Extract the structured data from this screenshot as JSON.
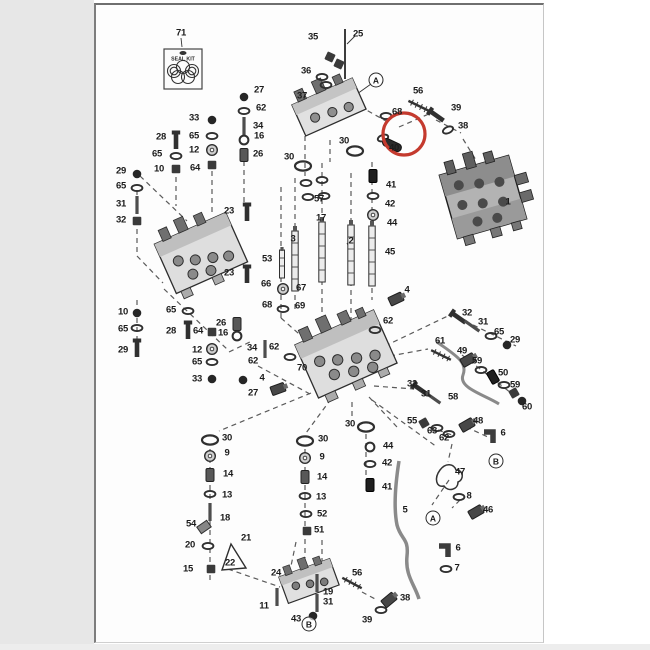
{
  "page": {
    "background": "#ffffff",
    "left_margin_color": "#e7e7e7",
    "paper_color": "#fdfdfd",
    "ink_color": "#2f2f2f"
  },
  "diagram": {
    "type": "exploded-parts-diagram",
    "subject": "hydraulic control valve assembly",
    "seal_kit": {
      "text": "SEAL KIT",
      "label": "71"
    },
    "highlight": {
      "circled_part": "40",
      "color": "#c43a2e",
      "cx": 404,
      "cy": 134,
      "r": 21,
      "stroke_width": 3.2
    },
    "ref_letters": [
      [
        "A",
        376,
        80
      ],
      [
        "B",
        496,
        461
      ],
      [
        "A",
        433,
        518
      ],
      [
        "B",
        309,
        624
      ]
    ],
    "labels": [
      [
        "71",
        181,
        33
      ],
      [
        "35",
        313,
        37
      ],
      [
        "25",
        358,
        34
      ],
      [
        "36",
        306,
        71
      ],
      [
        "37",
        302,
        96
      ],
      [
        "56",
        418,
        91
      ],
      [
        "68",
        397,
        112
      ],
      [
        "39",
        456,
        108
      ],
      [
        "38",
        463,
        126
      ],
      [
        "40",
        394,
        148
      ],
      [
        "30",
        344,
        141
      ],
      [
        "30",
        289,
        157
      ],
      [
        "1",
        508,
        202
      ],
      [
        "27",
        259,
        90
      ],
      [
        "62",
        261,
        108
      ],
      [
        "33",
        194,
        118
      ],
      [
        "34",
        258,
        126
      ],
      [
        "16",
        259,
        136
      ],
      [
        "65",
        194,
        136
      ],
      [
        "12",
        194,
        150
      ],
      [
        "26",
        258,
        154
      ],
      [
        "28",
        161,
        137
      ],
      [
        "65",
        157,
        154
      ],
      [
        "64",
        195,
        168
      ],
      [
        "10",
        159,
        169
      ],
      [
        "29",
        121,
        171
      ],
      [
        "65",
        121,
        186
      ],
      [
        "31",
        121,
        204
      ],
      [
        "32",
        121,
        220
      ],
      [
        "23",
        229,
        211
      ],
      [
        "23",
        229,
        273
      ],
      [
        "57",
        319,
        199
      ],
      [
        "17",
        321,
        218
      ],
      [
        "3",
        293,
        239
      ],
      [
        "2",
        351,
        241
      ],
      [
        "41",
        391,
        185
      ],
      [
        "42",
        390,
        204
      ],
      [
        "44",
        392,
        223
      ],
      [
        "45",
        390,
        252
      ],
      [
        "53",
        267,
        259
      ],
      [
        "66",
        266,
        284
      ],
      [
        "67",
        301,
        288
      ],
      [
        "68",
        267,
        305
      ],
      [
        "69",
        300,
        306
      ],
      [
        "4",
        407,
        290
      ],
      [
        "62",
        388,
        321
      ],
      [
        "10",
        123,
        312
      ],
      [
        "65",
        123,
        329
      ],
      [
        "29",
        123,
        350
      ],
      [
        "65",
        171,
        310
      ],
      [
        "28",
        171,
        331
      ],
      [
        "64",
        198,
        331
      ],
      [
        "26",
        221,
        323
      ],
      [
        "16",
        223,
        333
      ],
      [
        "12",
        197,
        350
      ],
      [
        "65",
        197,
        362
      ],
      [
        "33",
        197,
        379
      ],
      [
        "34",
        252,
        348
      ],
      [
        "62",
        253,
        361
      ],
      [
        "27",
        253,
        393
      ],
      [
        "62",
        274,
        347
      ],
      [
        "4",
        262,
        378
      ],
      [
        "70",
        302,
        368
      ],
      [
        "32",
        467,
        313
      ],
      [
        "31",
        483,
        322
      ],
      [
        "65",
        499,
        332
      ],
      [
        "29",
        515,
        340
      ],
      [
        "61",
        440,
        341
      ],
      [
        "49",
        462,
        351
      ],
      [
        "59",
        477,
        361
      ],
      [
        "50",
        503,
        373
      ],
      [
        "59",
        515,
        385
      ],
      [
        "32",
        412,
        384
      ],
      [
        "31",
        426,
        394
      ],
      [
        "58",
        453,
        397
      ],
      [
        "60",
        527,
        407
      ],
      [
        "55",
        412,
        421
      ],
      [
        "48",
        478,
        421
      ],
      [
        "63",
        432,
        431
      ],
      [
        "62",
        444,
        438
      ],
      [
        "6",
        503,
        433
      ],
      [
        "47",
        460,
        472
      ],
      [
        "8",
        469,
        496
      ],
      [
        "5",
        405,
        510
      ],
      [
        "46",
        488,
        510
      ],
      [
        "6",
        458,
        548
      ],
      [
        "7",
        457,
        568
      ],
      [
        "30",
        227,
        438
      ],
      [
        "9",
        227,
        453
      ],
      [
        "14",
        228,
        474
      ],
      [
        "13",
        227,
        495
      ],
      [
        "18",
        225,
        518
      ],
      [
        "54",
        191,
        524
      ],
      [
        "20",
        190,
        545
      ],
      [
        "21",
        246,
        538
      ],
      [
        "22",
        230,
        563
      ],
      [
        "15",
        188,
        569
      ],
      [
        "30",
        323,
        439
      ],
      [
        "9",
        322,
        457
      ],
      [
        "14",
        322,
        477
      ],
      [
        "13",
        321,
        497
      ],
      [
        "52",
        322,
        514
      ],
      [
        "51",
        319,
        530
      ],
      [
        "30",
        350,
        424
      ],
      [
        "44",
        388,
        446
      ],
      [
        "42",
        387,
        463
      ],
      [
        "41",
        387,
        487
      ],
      [
        "24",
        276,
        573
      ],
      [
        "56",
        357,
        573
      ],
      [
        "19",
        328,
        592
      ],
      [
        "31",
        328,
        602
      ],
      [
        "11",
        264,
        606
      ],
      [
        "43",
        296,
        619
      ],
      [
        "39",
        367,
        620
      ],
      [
        "38",
        405,
        598
      ]
    ],
    "parts": [
      [
        "pin",
        345,
        54,
        0
      ],
      [
        "nut",
        330,
        57,
        25
      ],
      [
        "nut",
        339,
        64,
        25
      ],
      [
        "oring-sm",
        322,
        77,
        0
      ],
      [
        "oring-sm",
        326,
        85,
        0
      ],
      [
        "oring-sm",
        386,
        116,
        0
      ],
      [
        "bolt",
        437,
        116,
        -55
      ],
      [
        "oring-sm",
        448,
        130,
        -25
      ],
      [
        "oring-sm",
        383,
        138,
        -20
      ],
      [
        "capsule",
        392,
        145,
        25
      ],
      [
        "oring",
        355,
        151,
        0
      ],
      [
        "oring",
        303,
        166,
        0
      ],
      [
        "ball",
        244,
        97,
        0
      ],
      [
        "oring-sm",
        244,
        111,
        0
      ],
      [
        "rod",
        244,
        126,
        0
      ],
      [
        "ring",
        244,
        140,
        0
      ],
      [
        "plug",
        244,
        155,
        0
      ],
      [
        "ball",
        212,
        120,
        0
      ],
      [
        "oring-sm",
        212,
        136,
        0
      ],
      [
        "washer",
        212,
        150,
        0
      ],
      [
        "nut",
        212,
        165,
        0
      ],
      [
        "bolt",
        176,
        141,
        0
      ],
      [
        "oring-sm",
        176,
        156,
        0
      ],
      [
        "nut",
        176,
        169,
        0
      ],
      [
        "ball",
        137,
        174,
        0
      ],
      [
        "oring-sm",
        137,
        188,
        0
      ],
      [
        "rod",
        137,
        205,
        0
      ],
      [
        "nut",
        137,
        221,
        0
      ],
      [
        "bolt",
        247,
        213,
        0
      ],
      [
        "bolt",
        247,
        275,
        0
      ],
      [
        "ball",
        137,
        313,
        0
      ],
      [
        "oring-sm",
        137,
        328,
        0
      ],
      [
        "bolt",
        137,
        349,
        0
      ],
      [
        "oring-sm",
        188,
        311,
        0
      ],
      [
        "bolt",
        188,
        331,
        0
      ],
      [
        "nut",
        212,
        332,
        0
      ],
      [
        "washer",
        212,
        349,
        0
      ],
      [
        "oring-sm",
        212,
        362,
        0
      ],
      [
        "ball",
        212,
        379,
        0
      ],
      [
        "plug",
        237,
        324,
        0
      ],
      [
        "ring",
        237,
        336,
        0
      ],
      [
        "rod",
        265,
        349,
        0
      ],
      [
        "oring-sm",
        290,
        357,
        0
      ],
      [
        "ball",
        243,
        380,
        0
      ],
      [
        "fitting",
        278,
        389,
        -20
      ],
      [
        "oring-sm",
        375,
        330,
        0
      ],
      [
        "fitting",
        396,
        299,
        -25
      ],
      [
        "oring-sm",
        306,
        183,
        0
      ],
      [
        "oring-sm",
        322,
        180,
        0
      ],
      [
        "oring-sm",
        308,
        197,
        0
      ],
      [
        "oring-sm",
        324,
        196,
        0
      ],
      [
        "spool",
        295,
        261,
        0
      ],
      [
        "spool",
        322,
        252,
        0
      ],
      [
        "spool",
        351,
        255,
        0
      ],
      [
        "spool",
        372,
        256,
        0
      ],
      [
        "plug-dk",
        373,
        176,
        0
      ],
      [
        "oring-sm",
        373,
        196,
        0
      ],
      [
        "washer",
        373,
        215,
        0
      ],
      [
        "spool-sm",
        282,
        264,
        0
      ],
      [
        "washer",
        283,
        289,
        0
      ],
      [
        "oring-sm",
        283,
        309,
        0
      ],
      [
        "oring",
        210,
        440,
        0
      ],
      [
        "washer",
        210,
        456,
        0
      ],
      [
        "plug",
        210,
        475,
        0
      ],
      [
        "oring-sm",
        210,
        494,
        0
      ],
      [
        "rod",
        210,
        512,
        0
      ],
      [
        "cap",
        204,
        527,
        -35
      ],
      [
        "oring-sm",
        208,
        546,
        0
      ],
      [
        "nut",
        211,
        569,
        0
      ],
      [
        "tri",
        233,
        557,
        0
      ],
      [
        "oring",
        305,
        441,
        0
      ],
      [
        "washer",
        305,
        458,
        0
      ],
      [
        "plug",
        305,
        477,
        0
      ],
      [
        "oring-sm",
        305,
        496,
        0
      ],
      [
        "oring-sm",
        306,
        514,
        0
      ],
      [
        "nut",
        307,
        531,
        0
      ],
      [
        "oring",
        366,
        427,
        0
      ],
      [
        "ring",
        370,
        447,
        0
      ],
      [
        "oring-sm",
        370,
        464,
        0
      ],
      [
        "plug-dk",
        370,
        485,
        0
      ],
      [
        "rod",
        317,
        583,
        0
      ],
      [
        "rod",
        317,
        603,
        0
      ],
      [
        "ball",
        313,
        616,
        0
      ],
      [
        "fitting",
        389,
        600,
        -40
      ],
      [
        "oring-sm",
        381,
        610,
        0
      ],
      [
        "rod",
        277,
        597,
        0
      ],
      [
        "bolt",
        459,
        318,
        -55
      ],
      [
        "rod",
        472,
        326,
        -55
      ],
      [
        "oring-sm",
        491,
        336,
        0
      ],
      [
        "ball",
        507,
        345,
        0
      ],
      [
        "fitting",
        468,
        360,
        -30
      ],
      [
        "oring-sm",
        481,
        370,
        0
      ],
      [
        "plug-dk",
        493,
        377,
        -30
      ],
      [
        "oring-sm",
        504,
        385,
        0
      ],
      [
        "nut",
        514,
        393,
        -30
      ],
      [
        "ball",
        522,
        401,
        0
      ],
      [
        "bolt",
        421,
        390,
        -55
      ],
      [
        "rod",
        433,
        398,
        -55
      ],
      [
        "nut",
        424,
        423,
        -30
      ],
      [
        "oring-sm",
        437,
        428,
        0
      ],
      [
        "oring-sm",
        449,
        434,
        0
      ],
      [
        "fitting",
        467,
        425,
        -30
      ],
      [
        "elbow",
        490,
        437,
        0
      ],
      [
        "oring-sm",
        459,
        497,
        0
      ],
      [
        "fitting",
        476,
        512,
        -30
      ],
      [
        "elbow",
        445,
        551,
        0
      ],
      [
        "oring-sm",
        446,
        569,
        0
      ]
    ]
  }
}
